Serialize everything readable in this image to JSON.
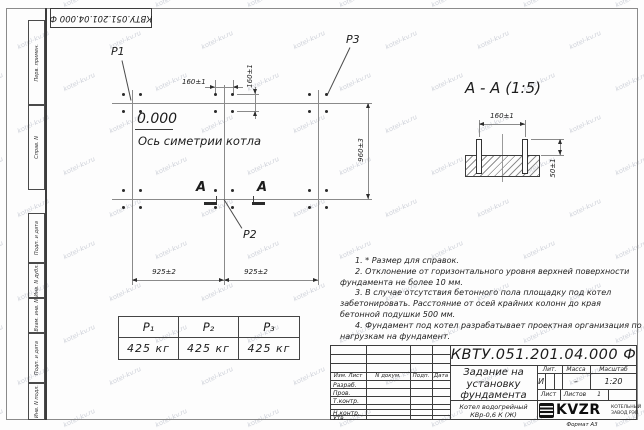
{
  "watermark": {
    "text": "kotel-kv.ru"
  },
  "frame": {
    "top_stamp": "КВТУ.051.201.04.000 Ф",
    "margin_labels": [
      "Перв. примен.",
      "Справ. N",
      "Подп. и дата",
      "Инв. N дубл.",
      "Взам. инв. N",
      "Подп. и дата",
      "Инв. N подл."
    ],
    "format_label": "Формат А3"
  },
  "plan": {
    "p1": "P1",
    "p2": "P2",
    "p3": "P3",
    "elevation": "0.000",
    "axis_label": "Ось симетрии котла",
    "section_mark": "А",
    "dim_bolt_spacing_h": "160±1",
    "dim_bolt_spacing_v": "160±1",
    "dim_rows": "960±3",
    "dim_col_left": "925±2",
    "dim_col_right": "925±2"
  },
  "section_view": {
    "title": "А - А (1:5)",
    "dim_bolt_spacing": "160±1",
    "dim_protrusion": "50±1"
  },
  "load_table": {
    "headers": [
      "P₁",
      "P₂",
      "P₃"
    ],
    "values": [
      "425 кг",
      "425 кг",
      "425 кг"
    ]
  },
  "notes": [
    "1. * Размер для справок.",
    "2. Отклонение от горизонтального уровня верхней поверхности фундамента не более 10 мм.",
    "3. В случае отсутствия бетонного пола площадку под котел забетонировать. Расстояние от осей крайних колонн до края бетонной подушки 500 мм.",
    "4. Фундамент под котел разрабатывает проектная организация по нагрузкам на фундамент."
  ],
  "title_block": {
    "doc_number": "КВТУ.051.201.04.000 Ф",
    "title": "Задание на установку фундамента",
    "product_line1": "Котел водогрейный",
    "product_line2": "КВр-0,6 К (Ж)",
    "rev_cols": [
      "Изм. Лист",
      "N докум.",
      "Подп.",
      "Дата"
    ],
    "roles": [
      "Разраб.",
      "Пров.",
      "Т.контр.",
      "Н.контр.",
      "Утв."
    ],
    "lit_label": "Лит.",
    "mass_label": "Масса",
    "scale_label": "Масштаб",
    "lit_value": "И",
    "mass_value": "–",
    "scale_value": "1:20",
    "sheet_label": "Лист",
    "sheets_label": "Листов",
    "sheets_value": "1",
    "logo_text": "KVZR",
    "company_line1": "КОТЕЛЬНЫЙ",
    "company_line2": "ЗАВОД РЭП"
  }
}
